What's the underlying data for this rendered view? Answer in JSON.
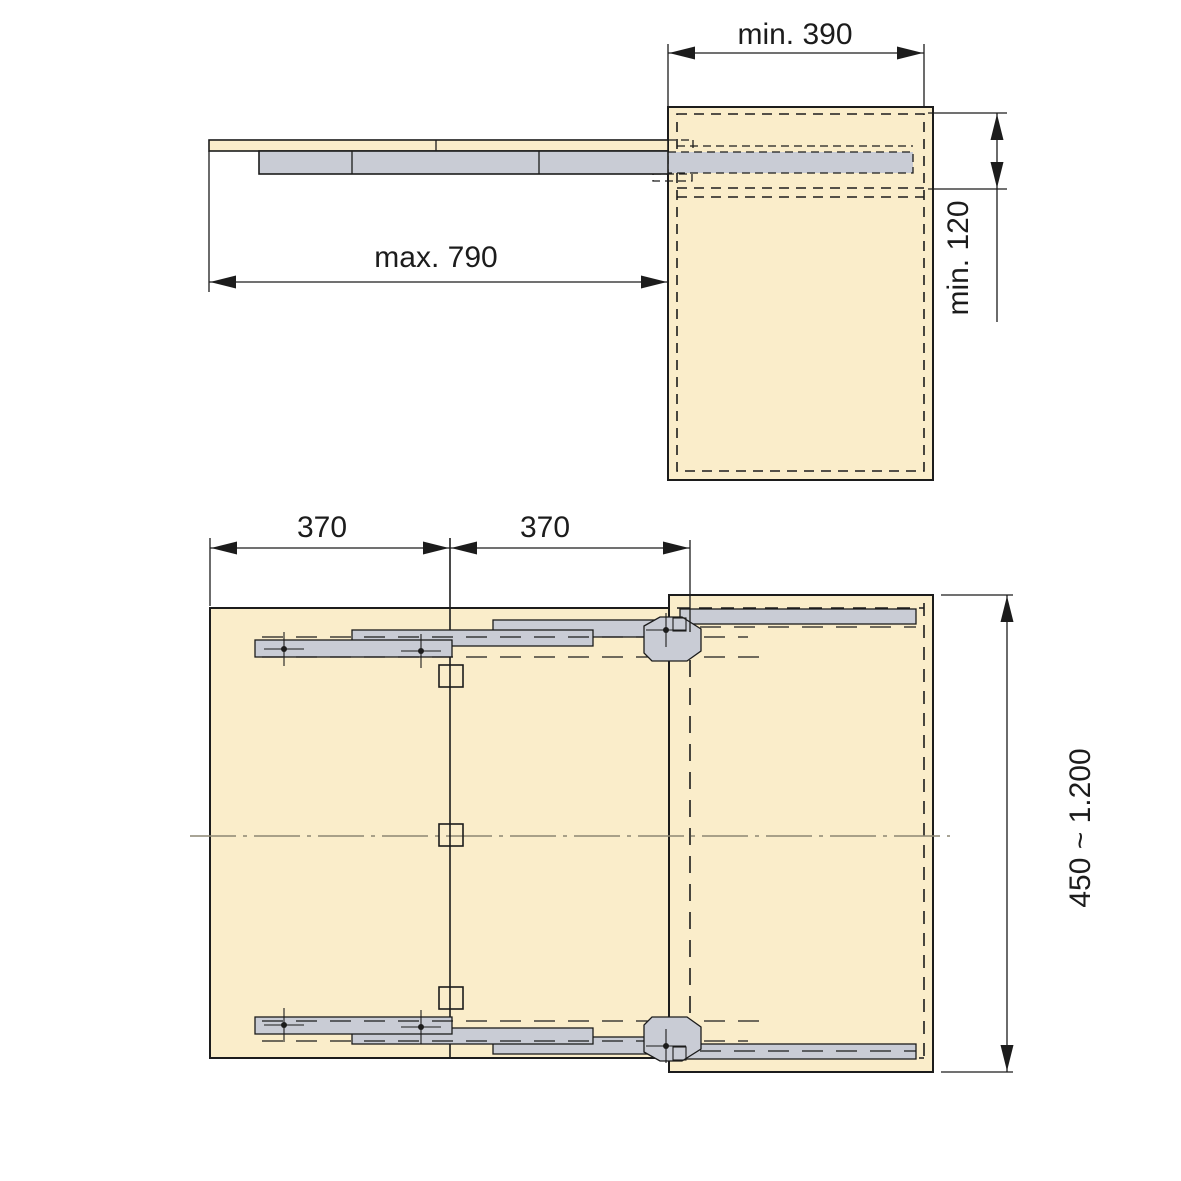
{
  "diagram": {
    "type": "technical-installation-drawing",
    "subject": "pull-out table slide mechanism, side elevation and plan view",
    "side_view": {
      "dim_cabinet_interior_width": "min. 390",
      "dim_pullout_extension": "max. 790",
      "dim_clearance_height": "min. 120"
    },
    "plan_view": {
      "dim_leaf_left": "370",
      "dim_leaf_right": "370",
      "dim_cabinet_depth_range": "450 ~ 1.200"
    },
    "colors": {
      "background": "#ffffff",
      "panel": "#faedca",
      "rail": "#c9ccd5",
      "line": "#1c1c1c",
      "hidden": "#2a2a2a",
      "centerline": "#8c8673",
      "text": "#1c1c1c"
    }
  }
}
